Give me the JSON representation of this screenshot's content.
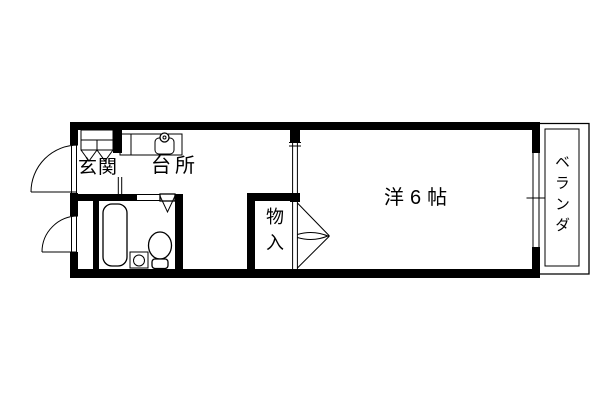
{
  "floor_plan": {
    "background_color": "#ffffff",
    "line_color": "#000000",
    "labels": {
      "entrance": "玄関",
      "kitchen": "台所",
      "closet": "物入",
      "main_room": "洋6帖",
      "balcony": "ベランダ"
    },
    "icons": {
      "bathtub": "rounded-rect",
      "toilet": "ellipse-with-tank",
      "wash_basin": "square-with-circle",
      "kitchen_sink": "rounded-rect-with-faucet-circle",
      "shoe_cabinet": "divided-rect-with-v-doors",
      "entrance_door": "quarter-arc-swing",
      "service_door": "quarter-arc-swing",
      "bathroom_door": "v-fold-door",
      "closet_doors": "double-swing-arcs",
      "balcony_window": "double-line-sliding",
      "balcony_railing": "double-rect"
    }
  }
}
